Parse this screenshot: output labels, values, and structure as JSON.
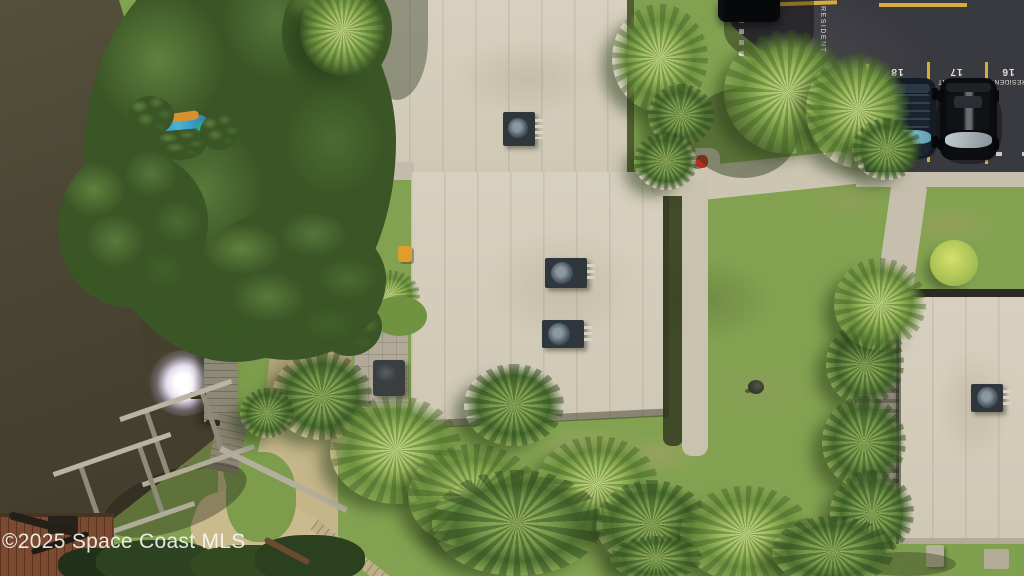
{
  "watermark": {
    "text": "©2025 Space Coast MLS"
  },
  "parking": {
    "edge_label": "RESIDENT",
    "stalls": [
      {
        "number": "18",
        "label": "RESIDENT"
      },
      {
        "number": "17",
        "label": "RESIDENT"
      },
      {
        "number": "16",
        "label": "RESIDENT"
      }
    ]
  },
  "palette": {
    "water": "#4b4633",
    "grass": "#83a251",
    "roof_concrete": "#d4cdbb",
    "asphalt": "#3a3a3e",
    "path_concrete": "#ccc5b2",
    "tree_canopy": "#3a5526",
    "palm": "#8fae55",
    "stall_line_yellow": "#d5ad3f",
    "marking_white": "#e8e5dc",
    "hydrant_red": "#c02a1e",
    "dock_wood": "#8e8876",
    "deck_wood": "#7b4a31"
  }
}
